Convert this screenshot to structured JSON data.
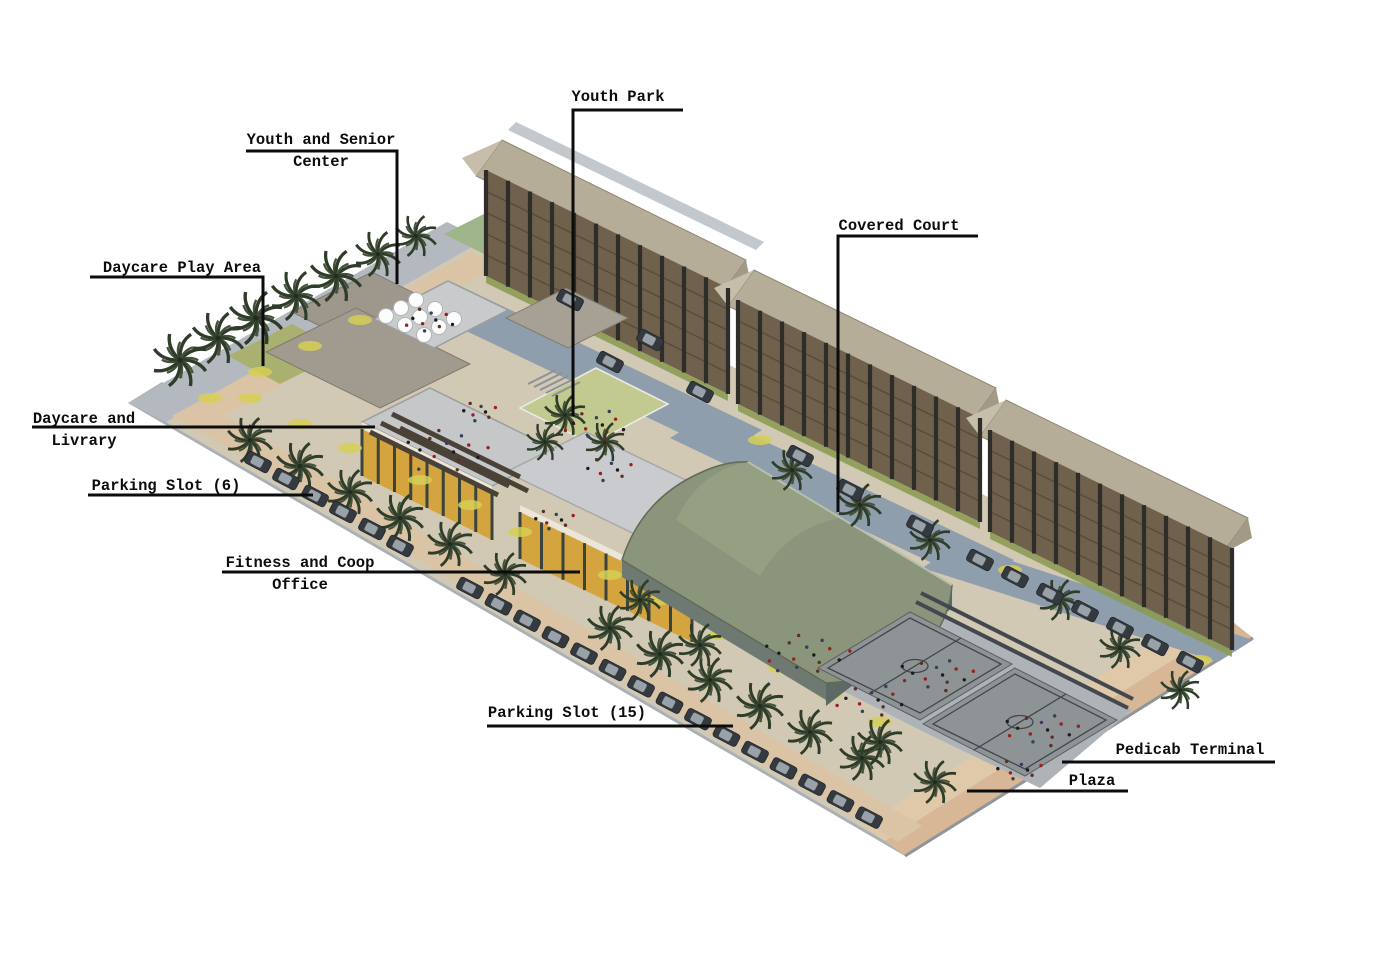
{
  "figure": {
    "type": "architectural-site-rendering",
    "view": "aerial-isometric",
    "background": "#ffffff",
    "description": "Aerial isometric rendering of a community housing complex: three five-storey residential slab buildings, community facilities with rooftop decks, a green barrel-vault covered court, two basketball courts, plaza, pedicab terminal and palm-lined parking roads."
  },
  "site_features": [
    "residential-building x3",
    "youth-and-senior-center",
    "daycare-and-library",
    "fitness-and-coop-office",
    "covered-court",
    "basketball-courts x2",
    "youth-park",
    "daycare-play-area",
    "parking-rows",
    "plaza",
    "pedicab-terminal",
    "palm-trees"
  ],
  "annotations": [
    {
      "id": "youth-park",
      "lines": [
        "Youth Park"
      ],
      "label_x": 618,
      "label_y": 88,
      "leader": [
        [
          683,
          110
        ],
        [
          573,
          110
        ],
        [
          573,
          416
        ]
      ]
    },
    {
      "id": "youth-and-senior-center",
      "lines": [
        "Youth and Senior",
        "Center"
      ],
      "label_x": 321,
      "label_y": 131,
      "leader": [
        [
          246,
          151
        ],
        [
          397,
          151
        ],
        [
          397,
          284
        ]
      ]
    },
    {
      "id": "covered-court",
      "lines": [
        "Covered Court"
      ],
      "label_x": 899,
      "label_y": 217,
      "leader": [
        [
          978,
          236
        ],
        [
          838,
          236
        ],
        [
          838,
          512
        ]
      ]
    },
    {
      "id": "daycare-play-area",
      "lines": [
        "Daycare Play Area"
      ],
      "label_x": 182,
      "label_y": 259,
      "leader": [
        [
          90,
          277
        ],
        [
          263,
          277
        ],
        [
          263,
          366
        ]
      ]
    },
    {
      "id": "daycare-and-livrary",
      "lines": [
        "Daycare and",
        "Livrary"
      ],
      "label_x": 84,
      "label_y": 410,
      "leader": [
        [
          32,
          427
        ],
        [
          375,
          427
        ]
      ]
    },
    {
      "id": "parking-slot-6",
      "lines": [
        "Parking Slot (6)"
      ],
      "label_x": 166,
      "label_y": 477,
      "leader": [
        [
          88,
          495
        ],
        [
          313,
          495
        ]
      ]
    },
    {
      "id": "fitness-and-coop-office",
      "lines": [
        "Fitness and Coop",
        "Office"
      ],
      "label_x": 300,
      "label_y": 554,
      "leader": [
        [
          222,
          572
        ],
        [
          580,
          572
        ]
      ]
    },
    {
      "id": "parking-slot-15",
      "lines": [
        "Parking Slot (15)"
      ],
      "label_x": 567,
      "label_y": 704,
      "leader": [
        [
          487,
          726
        ],
        [
          733,
          726
        ]
      ]
    },
    {
      "id": "pedicab-terminal",
      "lines": [
        "Pedicab Terminal"
      ],
      "label_x": 1190,
      "label_y": 741,
      "leader": [
        [
          1275,
          762
        ],
        [
          1062,
          762
        ]
      ]
    },
    {
      "id": "plaza",
      "lines": [
        "Plaza"
      ],
      "label_x": 1092,
      "label_y": 772,
      "leader": [
        [
          1128,
          791
        ],
        [
          967,
          791
        ]
      ]
    }
  ],
  "colors": {
    "background": "#ffffff",
    "label_text": "#0c0c0c",
    "leader_line": "#0c0c0c",
    "building_facade": "#6f614c",
    "building_column": "#2f2d29",
    "building_roof": "#b5ad97",
    "covered_court_roof": "#8a957b",
    "yellow_facade": "#d4a53f",
    "perimeter_road": "#a9b0b6",
    "interior_road": "#8f9eac",
    "walkway": "#dac4a5",
    "plaza": "#e0c9a9",
    "pedicab_terminal": "#d7b795",
    "court_surface": "#8e9396",
    "lawn": "#c3ca90",
    "palm_foliage": "#2e3c29",
    "car_body": "#343a40"
  }
}
